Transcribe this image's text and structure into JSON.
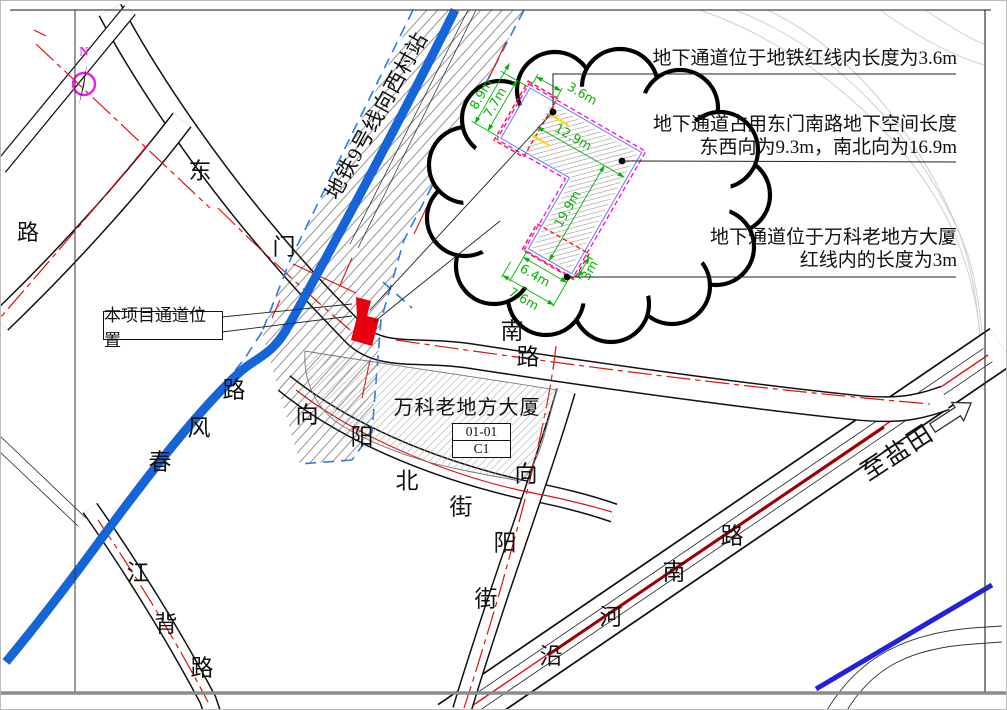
{
  "compass": {
    "north": "N"
  },
  "metro": {
    "label": "地铁9号线向西村站"
  },
  "annotations": {
    "a1": "地下通道位于地铁红线内长度为3.6m",
    "a2_line1": "地下通道占用东门南路地下空间长度",
    "a2_line2": "东西向为9.3m，南北向为16.9m",
    "a3_line1": "地下通道位于万科老地方大厦",
    "a3_line2": "红线内的长度为3m"
  },
  "callout": {
    "passage_label": "本项目通道位置"
  },
  "building": {
    "name": "万科老地方大厦",
    "parcel_no": "01-01",
    "block": "C1"
  },
  "cloud": {
    "dims": {
      "d89": "8.9m",
      "d77": "7.7m",
      "d36": "3.6m",
      "d129": "12.9m",
      "d199": "19.9m",
      "d64": "6.4m",
      "d76": "7.6m",
      "d3": "3m"
    }
  },
  "roads": {
    "dongmen_nan_lu": [
      "东",
      "门",
      "南",
      "路"
    ],
    "west_edge_lu": "路",
    "chunfeng_lu": [
      "春",
      "风",
      "路"
    ],
    "jiangbei_lu": [
      "江",
      "背",
      "路"
    ],
    "xiangyang_bei_jie": [
      "向",
      "阳",
      "北",
      "街"
    ],
    "xiangyang_jie": [
      "向",
      "阳",
      "街"
    ],
    "yanhe_nan_lu": [
      "沿",
      "河",
      "南",
      "路"
    ],
    "to_yantian": "至盐田"
  },
  "colors": {
    "metro_blue": "#1565d8",
    "corner_blue": "#2222dd",
    "marker_red": "#e8000e",
    "redline": "#e01010",
    "dim_green": "#00b400",
    "magenta": "#ff00ff",
    "yellow": "#ffd800"
  }
}
